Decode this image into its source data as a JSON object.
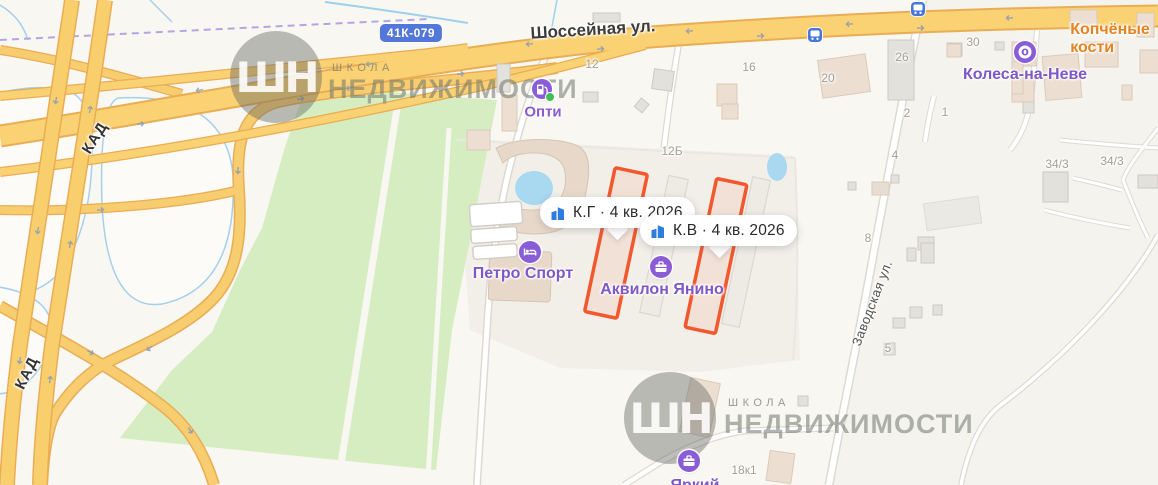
{
  "streets": {
    "main": "Шоссейная ул.",
    "side": "Заводская ул.",
    "ringroad": "КАД",
    "shield": "41К-079"
  },
  "pois": {
    "opti": {
      "label": "Опти",
      "icon": "fuel-station-icon"
    },
    "petro_sport": {
      "label": "Петро Спорт",
      "icon": "hotel-icon"
    },
    "akvilon": {
      "label": "Аквилон Янино",
      "icon": "briefcase-icon"
    },
    "kolesa": {
      "label": "Колеса-на-Неве",
      "icon": "tire-icon"
    },
    "kopchyonye": {
      "label": "Копчёные кости",
      "icon": "none"
    },
    "yarkiy": {
      "label": "Яркий",
      "icon": "briefcase-icon"
    }
  },
  "tooltips": [
    {
      "label": "К.Г · 4 кв. 2026",
      "icon": "building-icon"
    },
    {
      "label": "К.В · 4 кв. 2026",
      "icon": "building-icon"
    }
  ],
  "numbers": [
    {
      "t": "12"
    },
    {
      "t": "16"
    },
    {
      "t": "20"
    },
    {
      "t": "26"
    },
    {
      "t": "30"
    },
    {
      "t": "2"
    },
    {
      "t": "1"
    },
    {
      "t": "12Б"
    },
    {
      "t": "4"
    },
    {
      "t": "34/3"
    },
    {
      "t": "34/3"
    },
    {
      "t": "8"
    },
    {
      "t": "5"
    },
    {
      "t": "18к1"
    }
  ],
  "watermark": {
    "logo": "ШН",
    "school": "ШКОЛА",
    "realty": "НЕДВИЖИМОСТИ"
  },
  "colors": {
    "poi_purple": "#8a5cd6",
    "poi_label_purple": "#7e57c8",
    "poi_orange": "#e8821e",
    "road_orange_fill": "#fad173",
    "road_orange_casing": "#e9ad54",
    "highlight_building": "#f2572e",
    "shield_blue": "#5377d8",
    "tooltip_icon_blue": "#2f7ce0",
    "green_area": "#d6edc2",
    "water": "#a8d9f1"
  }
}
